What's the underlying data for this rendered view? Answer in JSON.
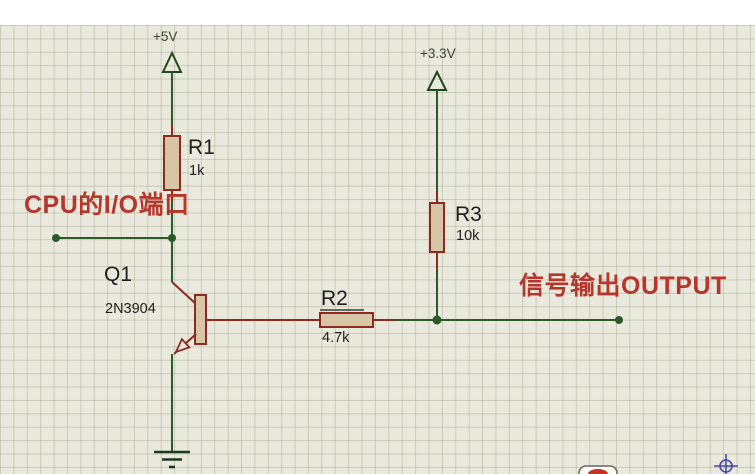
{
  "canvas": {
    "top_band_color": "#ffffff",
    "background": "#eae9de",
    "grid_cell_px": 13.4
  },
  "power_rails": [
    {
      "label": "+5V"
    },
    {
      "label": "+3.3V"
    }
  ],
  "components": [
    {
      "ref": "R1",
      "value": "1k",
      "type": "resistor"
    },
    {
      "ref": "R2",
      "value": "4.7k",
      "type": "resistor"
    },
    {
      "ref": "R3",
      "value": "10k",
      "type": "resistor"
    },
    {
      "ref": "Q1",
      "value": "2N3904",
      "type": "npn-transistor"
    }
  ],
  "annotations": {
    "input_label": "CPU的I/O端口",
    "output_label": "信号输出OUTPUT"
  },
  "colors": {
    "canvas_bg": "#eae9de",
    "wire": "#2a5a28",
    "pin": "#8b2b20",
    "resistor_fill": "#d7c5a5",
    "power_symbol": "#1d4a1d",
    "label_text": "#1e1e1e",
    "power_text": "#3a4334",
    "annotation_red": "#b5372c",
    "origin_marker": "#4a4aa0"
  }
}
